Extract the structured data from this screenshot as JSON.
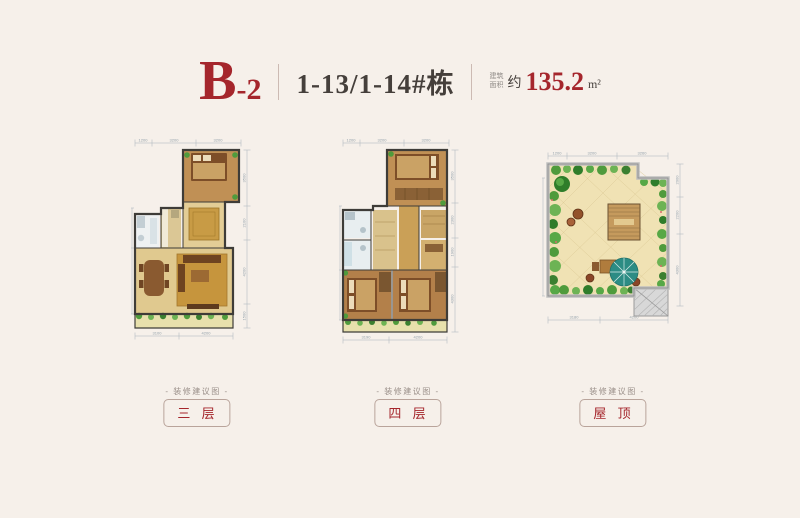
{
  "header": {
    "code_main": "B",
    "code_suffix": "-2",
    "building": "1-13/1-14#栋",
    "area_label_top": "建筑",
    "area_label_bottom": "面积",
    "area_approx": "约",
    "area_value": "135.2",
    "area_unit": "m²"
  },
  "plans": [
    {
      "name": "floor-3",
      "caption": "- 装修建议图 -",
      "label": "三 层",
      "dims": {
        "top": [
          "1200",
          "3200",
          "3200"
        ],
        "right": [
          "3500",
          "2100",
          "4200",
          "1500"
        ],
        "bottom": [
          "3100",
          "4200"
        ]
      }
    },
    {
      "name": "floor-4",
      "caption": "- 装修建议图 -",
      "label": "四 层",
      "dims": {
        "top": [
          "1200",
          "3200",
          "3200"
        ],
        "right": [
          "3500",
          "2300",
          "1900",
          "4300"
        ],
        "bottom": [
          "3190",
          "4200"
        ]
      }
    },
    {
      "name": "roof",
      "caption": "- 装修建议图 -",
      "label": "屋 顶",
      "dims": {
        "top": [
          "1200",
          "3200",
          "3260"
        ],
        "right": [
          "2000",
          "2200",
          "4300"
        ],
        "bottom": [
          "3180",
          "4200"
        ]
      }
    }
  ],
  "colors": {
    "accent": "#a5262c",
    "text_dark": "#453f3b",
    "background": "#f6f0ea",
    "dim_line": "#9aa7b0",
    "wall": "#3e3c38",
    "wood_floor": "#b3804a",
    "tile_floor": "#e7e0ac",
    "plant_green": "#4f9b3c",
    "umbrella_teal": "#2c8c84",
    "roof_gray": "#d8d8d8"
  }
}
